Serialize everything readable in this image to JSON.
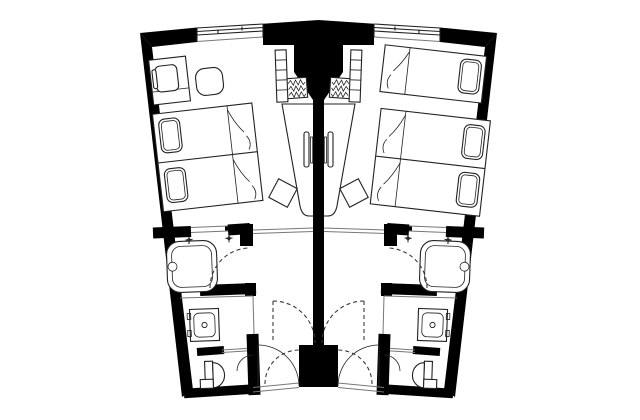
{
  "meta": {
    "type": "architectural-floor-plan",
    "description": "Plan of two mirrored fan-shaped hotel guest rooms separated by a central party wall, each with entry vestibule, bathroom block and window wall at top"
  },
  "colors": {
    "bg": "#ffffff",
    "wall": "#000000",
    "line": "#222222",
    "thin": "#777777",
    "dash": "#3a3a3a"
  },
  "rooms": {
    "left": {
      "name": "guest-room-left",
      "bed_count": 2,
      "furniture": [
        "desk",
        "desk-chair",
        "ottoman",
        "twin-bed",
        "twin-bed",
        "wall-console",
        "tv",
        "stool",
        "luggage-rack",
        "shelf-unit"
      ],
      "bathroom_fixtures": [
        "bathtub",
        "tub-taps",
        "washbasin",
        "toilet"
      ]
    },
    "right": {
      "name": "guest-room-right",
      "bed_count": 3,
      "furniture": [
        "single-bed",
        "twin-bed",
        "twin-bed",
        "wall-console",
        "tv",
        "stool",
        "luggage-rack",
        "shelf-unit"
      ],
      "bathroom_fixtures": [
        "bathtub",
        "tub-taps",
        "washbasin",
        "toilet"
      ]
    }
  },
  "openings": {
    "windows": 2,
    "entry_doors": 2,
    "bathroom_doors": 2,
    "connecting_door_swings": 2
  }
}
